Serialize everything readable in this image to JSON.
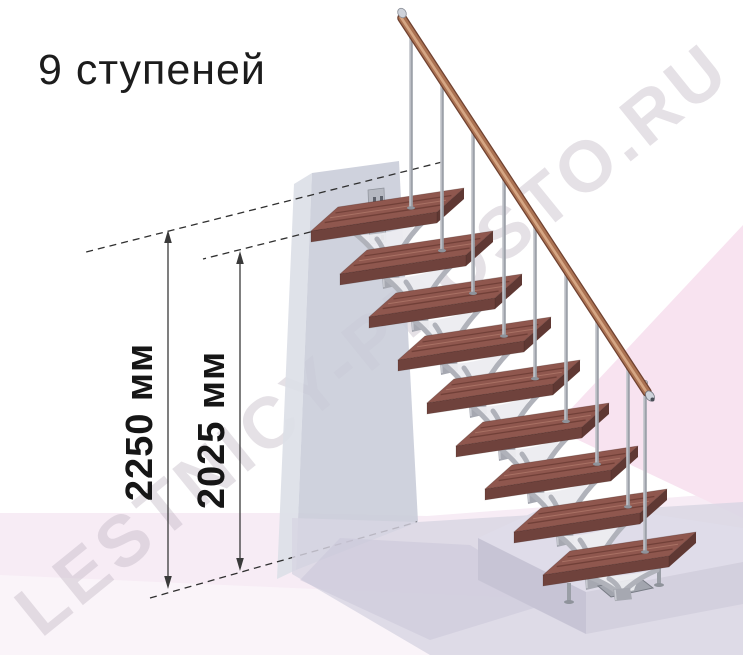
{
  "title": "9 ступеней",
  "watermark": "LESTNICY-PROSTO.RU",
  "dimension_labels": {
    "total_height": "2250 мм",
    "to_top_step": "2025 мм"
  },
  "stairs": {
    "step_count": 9,
    "colors": {
      "tread_top": "#8f574e",
      "tread_front": "#6f423c",
      "tread_side": "#5f3833",
      "grain_dark": "rgba(90,45,38,0.55)",
      "grain_light": "rgba(196,140,122,0.5)",
      "metal": "#a6a8b1",
      "metal_light": "#c9cbd2",
      "arm": "#b0b2ba",
      "plate": "#ececf0",
      "baluster": "#9da1a9",
      "baluster_hi": "#e6e8ec",
      "rail_dark": "#6f4130",
      "rail_mid": "#ab7252",
      "rail_hi": "#d8a987",
      "cap": "#ced2da",
      "foot": "#8f939b",
      "wall_plate": "#b5b8c1",
      "wall_plate_hole": "#5d616b"
    }
  },
  "background": {
    "colors": {
      "white": "#ffffff",
      "pink_low": "#f7ecf5",
      "pink_right": "#f8e3f0",
      "wedge": "rgba(255,255,255,0.42)",
      "floor": "#d8d5e3",
      "floor_shade": "#cbc7d8",
      "platform_top": "#dfdce9",
      "platform_left": "#c7c4d5",
      "platform_right": "#d3d0de",
      "wall_side": "#dcdfe7",
      "wall_front": "#c7cbd7"
    }
  },
  "annotation": {
    "line_color": "#2f2f2f",
    "watermark_color": "rgba(186,176,188,0.38)"
  }
}
